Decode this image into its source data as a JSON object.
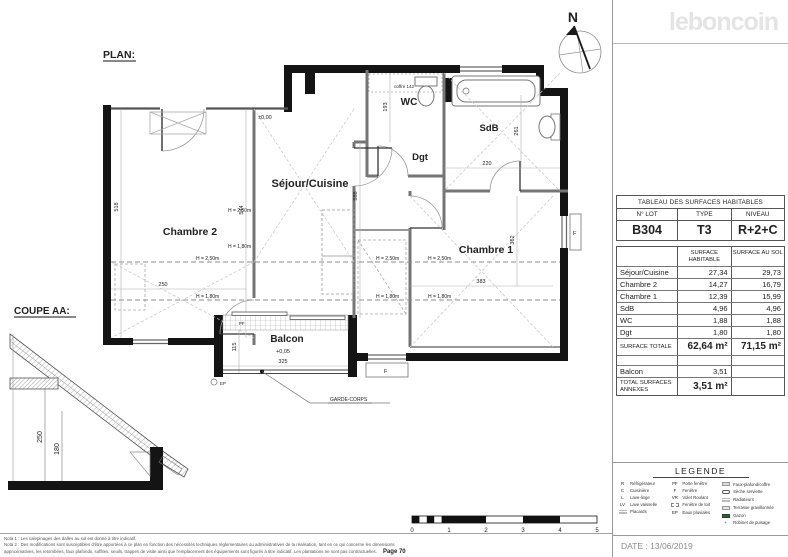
{
  "brand": {
    "logo_text": "leboncoin"
  },
  "plan": {
    "title": "PLAN:",
    "north_letter": "N",
    "rooms": {
      "sejour": "Séjour/Cuisine",
      "chambre2": "Chambre 2",
      "chambre1": "Chambre 1",
      "wc": "WC",
      "sdb": "SdB",
      "dgt": "Dgt",
      "balcon": "Balcon"
    },
    "levels": {
      "entry": "±0,00",
      "balcon": "+0,05"
    },
    "heights": {
      "h250": "H = 2,50m",
      "h180": "H = 1,80m"
    },
    "dims": {
      "left_wall": "518",
      "chambre2_height": "544",
      "sejour_height": "588",
      "chambre1_height": "362",
      "chambre2_width": "250",
      "chambre1_width": "383",
      "sdb_width": "220",
      "wc_depth": "193",
      "sdb_depth": "261",
      "balcon_depth": "115",
      "balcon_width": "325",
      "coffre": "coffre 142"
    },
    "labels": {
      "garde_corps": "GARDE-CORPS",
      "window_f": "F",
      "window_pf": "PF",
      "ep": "EP"
    },
    "scale_ticks": [
      "0",
      "1",
      "2",
      "3",
      "4",
      "5"
    ]
  },
  "coupe": {
    "title": "COUPE AA:",
    "dims": {
      "h1": "250",
      "h2": "180"
    }
  },
  "surface_table": {
    "title": "TABLEAU DES SURFACES HABITABLES",
    "lot_label": "N° LOT",
    "type_label": "TYPE",
    "niveau_label": "NIVEAU",
    "lot": "B304",
    "type": "T3",
    "niveau": "R+2+C",
    "col_habitable": "SURFACE HABITABLE",
    "col_sol": "SURFACE AU SOL",
    "rows": [
      {
        "name": "Séjour/Cuisine",
        "hab": "27,34",
        "sol": "29,73"
      },
      {
        "name": "Chambre 2",
        "hab": "14,27",
        "sol": "16,79"
      },
      {
        "name": "Chambre 1",
        "hab": "12,39",
        "sol": "15,99"
      },
      {
        "name": "SdB",
        "hab": "4,96",
        "sol": "4,96"
      },
      {
        "name": "WC",
        "hab": "1,88",
        "sol": "1,88"
      },
      {
        "name": "Dgt",
        "hab": "1,80",
        "sol": "1,80"
      }
    ],
    "total_label": "SURFACE TOTALE",
    "total_hab": "62,64 m²",
    "total_sol": "71,15 m²",
    "balcon_label": "Balcon",
    "balcon_value": "3,51",
    "annexes_label": "TOTAL SURFACES ANNEXES",
    "annexes_value": "3,51 m²"
  },
  "legend": {
    "title": "LEGENDE",
    "col1": [
      {
        "sym": "R",
        "label": "Réfrigérateur"
      },
      {
        "sym": "C",
        "label": "Cuisinière"
      },
      {
        "sym": "L",
        "label": "Lave-linge"
      },
      {
        "sym": "LV",
        "label": "Lave vaisselle"
      },
      {
        "sym": "",
        "label": "Placards"
      }
    ],
    "col2": [
      {
        "sym": "PF",
        "label": "Porte fenêtre"
      },
      {
        "sym": "F",
        "label": "Fenêtre"
      },
      {
        "sym": "VR",
        "label": "Volet Roulant"
      },
      {
        "sym": "",
        "label": "Fenêtre de toit"
      },
      {
        "sym": "EP",
        "label": "Eaux pluviales"
      }
    ],
    "col3": [
      {
        "label": "Faux-plafond/coffre"
      },
      {
        "label": "Sèche serviette"
      },
      {
        "label": "Radiateurs"
      },
      {
        "label": "Terrasse gravillonnée"
      },
      {
        "label": "Gazon"
      },
      {
        "label": "Robinet de puisage"
      }
    ]
  },
  "footer": {
    "note1": "Nota 1 : Les calepinages des dalles au sol est donné à titre indicatif.",
    "note2": "Nota 2 : Des modifications sont susceptibles d'être apportées à ce plan en fonction des nécessités techniques réglementaires ou administratives de la réalisation, tant en ce qui concerne les dimensions",
    "note3": "approximatives, les retombées, faux plafonds, soffites, seuils, trappes de visite ainsi que l'emplacement des équipements sont figurés à titre indicatif. Les plantations ne sont pas contractuelles.",
    "page_ref": "Page 70",
    "date": "DATE : 13/06/2019"
  }
}
